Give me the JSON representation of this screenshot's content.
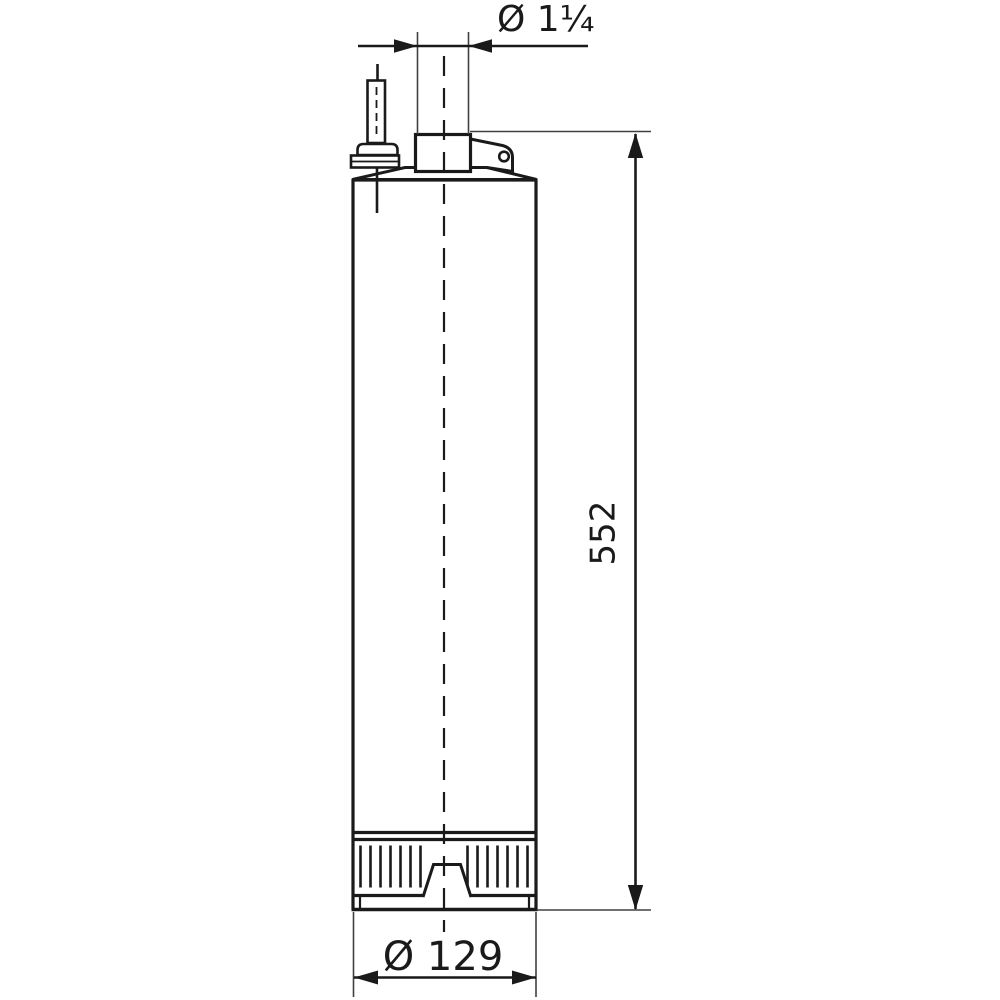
{
  "page": {
    "background": "#ffffff",
    "line_color": "#1a1a1a",
    "description": "Technical dimensional drawing of a submersible borehole pump, side view"
  },
  "drawing": {
    "dimensions": {
      "outlet_diameter_label": "Ø 1¼",
      "overall_height_label": "552",
      "body_diameter_label": "Ø 129"
    }
  }
}
